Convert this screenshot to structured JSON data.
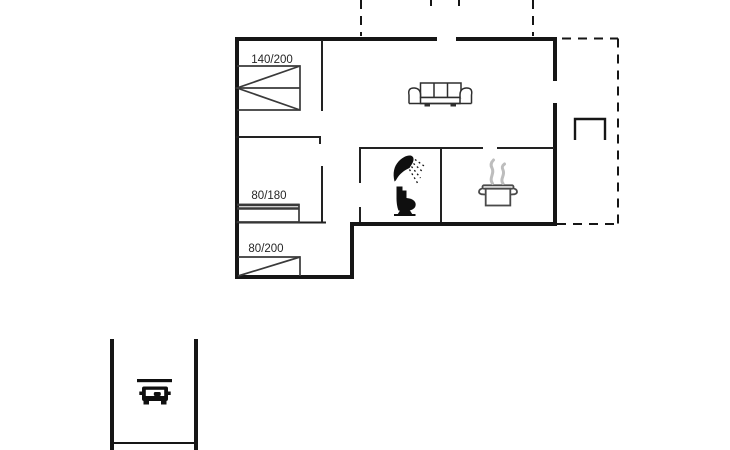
{
  "floorplan": {
    "background_color": "#ffffff",
    "wall_color": "#161616",
    "furniture_line_color": "#333333",
    "steam_color": "#bdbdbd",
    "house": {
      "outline": "solid-thick",
      "bedroom1": {
        "bed_size_label": "140/200",
        "bed_icon": "double-bed-icon"
      },
      "bedroom2": {
        "bed_size_label": "80/180",
        "bed_icon": "single-bed-icon"
      },
      "bedroom3": {
        "bed_size_label": "80/200",
        "bed_icon": "single-bed-icon"
      },
      "living_room": {
        "icon": "sofa-icon"
      },
      "bathroom": {
        "icons": [
          "shower-icon",
          "toilet-icon"
        ]
      },
      "kitchen": {
        "icon": "cooking-pot-icon",
        "steam_icon": "steam-icon"
      },
      "terrace": {
        "outline": "dashed",
        "icon": "bench-icon"
      }
    },
    "carport": {
      "outline": "open-walls",
      "icon": "car-icon"
    }
  }
}
